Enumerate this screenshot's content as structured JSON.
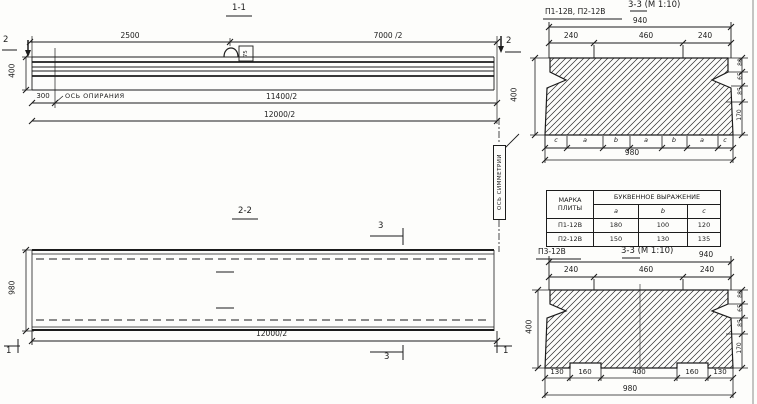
{
  "view_1_1": {
    "title": "1-1",
    "dim_2500": "2500",
    "dim_7000_2": "7000 /2",
    "marker_left": "2",
    "marker_right": "2",
    "loop_tag": "75",
    "dim_400": "400",
    "dim_300": "300",
    "support_axis_label": "ОСЬ ОПИРАНИЯ",
    "dim_11400_2": "11400/2",
    "dim_12000_2": "12000/2"
  },
  "view_2_2": {
    "title": "2-2",
    "marker_3_top": "3",
    "marker_3_bottom": "3",
    "marker_1_left": "1",
    "marker_1_right": "1",
    "dim_980": "980",
    "dim_12000_2": "12000/2",
    "symmetry_axis_label": "ОСЬ СИММЕТРИИ"
  },
  "section_top": {
    "label": "П1-12В, П2-12В",
    "title": "3-3 (М 1:10)",
    "dim_940": "940",
    "dim_240_left": "240",
    "dim_460": "460",
    "dim_240_right": "240",
    "dim_400": "400",
    "right_stack": [
      "80",
      "65",
      "85",
      "170"
    ],
    "letters": [
      "c",
      "a",
      "b",
      "a",
      "b",
      "a",
      "c"
    ],
    "dim_980": "980"
  },
  "table": {
    "col1_line1": "МАРКА",
    "col1_line2": "ПЛИТЫ",
    "span_header": "БУКВЕННОЕ ВЫРАЖЕНИЕ",
    "sub": [
      "a",
      "b",
      "c"
    ],
    "rows": [
      {
        "mark": "П1-12В",
        "a": "180",
        "b": "100",
        "c": "120"
      },
      {
        "mark": "П2-12В",
        "a": "150",
        "b": "130",
        "c": "135"
      }
    ]
  },
  "section_bottom": {
    "label": "П3-12В",
    "title": "3-3 (М 1:10)",
    "dim_940": "940",
    "dim_240_left": "240",
    "dim_460": "460",
    "dim_240_right": "240",
    "dim_400": "400",
    "right_stack": [
      "80",
      "65",
      "85",
      "170"
    ],
    "bottom_dims": [
      "130",
      "160",
      "400",
      "160",
      "130"
    ],
    "dim_980": "980"
  }
}
